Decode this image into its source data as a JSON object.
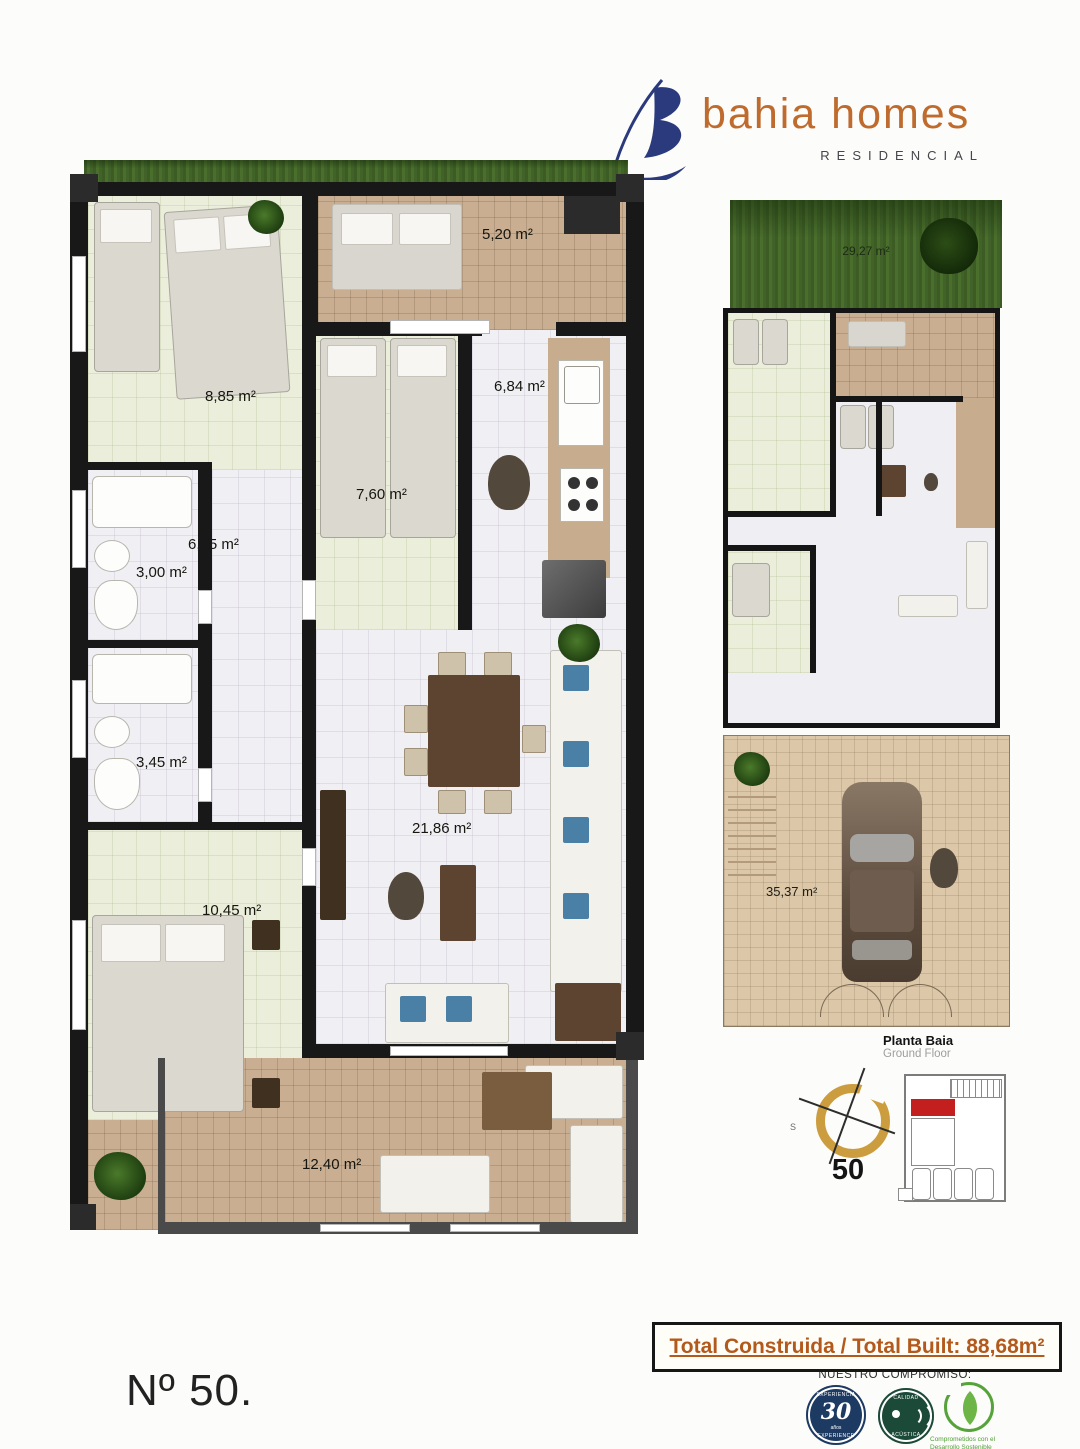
{
  "brand": {
    "name": "bahia homes",
    "subtitle": "RESIDENCIAL",
    "logo_mark_icon": "sail-b-logo",
    "logo_blue": "#2b3a7d",
    "brand_orange": "#bf6b2e"
  },
  "main_plan": {
    "rooms": [
      {
        "id": "bedroom-twin",
        "area": "8,85 m²"
      },
      {
        "id": "terrace-top",
        "area": "5,20 m²"
      },
      {
        "id": "bedroom-small",
        "area": "7,60 m²"
      },
      {
        "id": "kitchen",
        "area": "6,84 m²"
      },
      {
        "id": "hallway",
        "area": "6,45 m²"
      },
      {
        "id": "bathroom-1",
        "area": "3,00 m²"
      },
      {
        "id": "bathroom-2",
        "area": "3,45 m²"
      },
      {
        "id": "bedroom-master",
        "area": "10,45 m²"
      },
      {
        "id": "living-room",
        "area": "21,86 m²"
      },
      {
        "id": "terrace-bottom",
        "area": "12,40 m²"
      }
    ]
  },
  "ground_plan": {
    "garden_area": "29,27 m²",
    "driveway_area": "35,37 m²",
    "caption_title": "Planta Baia",
    "caption_subtitle": "Ground Floor"
  },
  "compass": {
    "south_letter": "S",
    "unit_number": "50"
  },
  "site_plan": {
    "highlight_color": "#c41f1f"
  },
  "footer": {
    "total_built": "Total Construida / Total Built: 88,68m²",
    "commitment_title": "NUESTRO COMPROMISO:",
    "badges": [
      {
        "id": "experience-badge",
        "top": "EXPERIENCIA",
        "number": "30",
        "sub": "años",
        "bottom": "EXPERIENCE"
      },
      {
        "id": "acoustic-badge",
        "top": "CALIDAD",
        "bottom": "ACÚSTICA"
      },
      {
        "id": "sustainability-badge",
        "caption_line1": "Comprometidos con el",
        "caption_line2": "Desarrollo Sostenible"
      }
    ],
    "unit_label": "Nº 50."
  }
}
